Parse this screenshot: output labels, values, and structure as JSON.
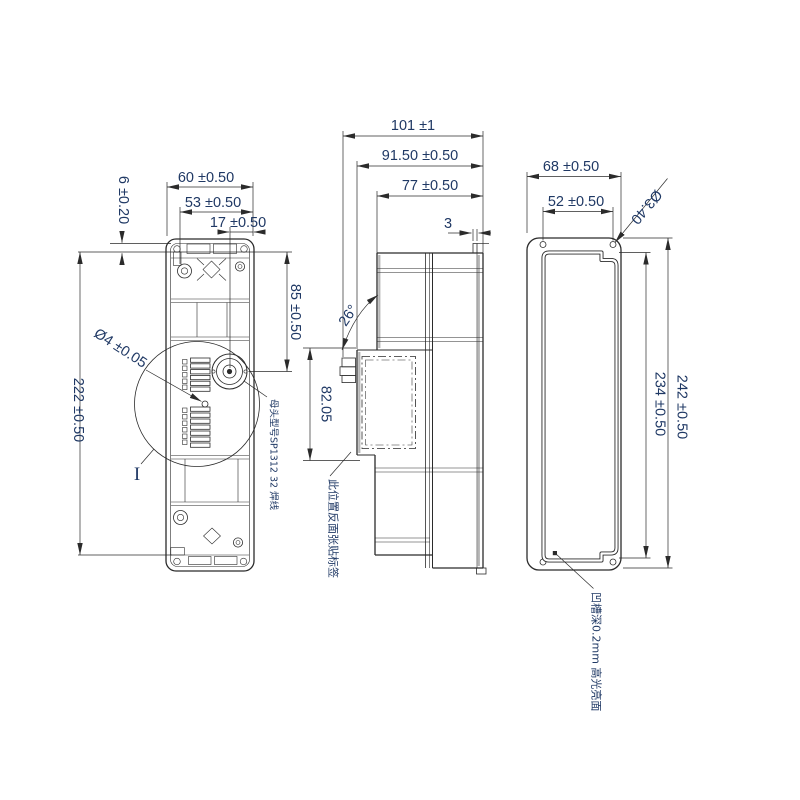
{
  "drawing_type": "mechanical engineering drawing, 3 orthographic views of an enclosure",
  "colors": {
    "line": "#2b2b2b",
    "dim_text": "#1f3864",
    "background": "#ffffff"
  },
  "views": {
    "front": {
      "dims": {
        "width_outer": "60 ±0.50",
        "width_inner": "53 ±0.50",
        "connector_offset": "17 ±0.50",
        "top_offset": "6 ±0.20",
        "height": "222 ±0.50",
        "connector_height": "85 ±0.50",
        "hole_dia": "Ø4 ±0.05"
      },
      "detail_label": "I",
      "connector_note": "母头型号SP1312 32 焊线"
    },
    "side": {
      "dims": {
        "depth_overall": "101 ±1",
        "depth_body": "91.50 ±0.50",
        "depth_inner": "77 ±0.50",
        "tab_thickness": "3",
        "angle": "26°",
        "label_area_height": "82.05"
      },
      "label_note": "此位置反面张贴标签"
    },
    "back": {
      "dims": {
        "width_outer": "68 ±0.50",
        "hole_spacing": "52 ±0.50",
        "hole_dia": "Ø3.40",
        "height_outer": "242 ±0.50",
        "height_groove": "234 ±0.50"
      },
      "groove_note": "凹槽深0.2mm 高光亮面"
    }
  }
}
